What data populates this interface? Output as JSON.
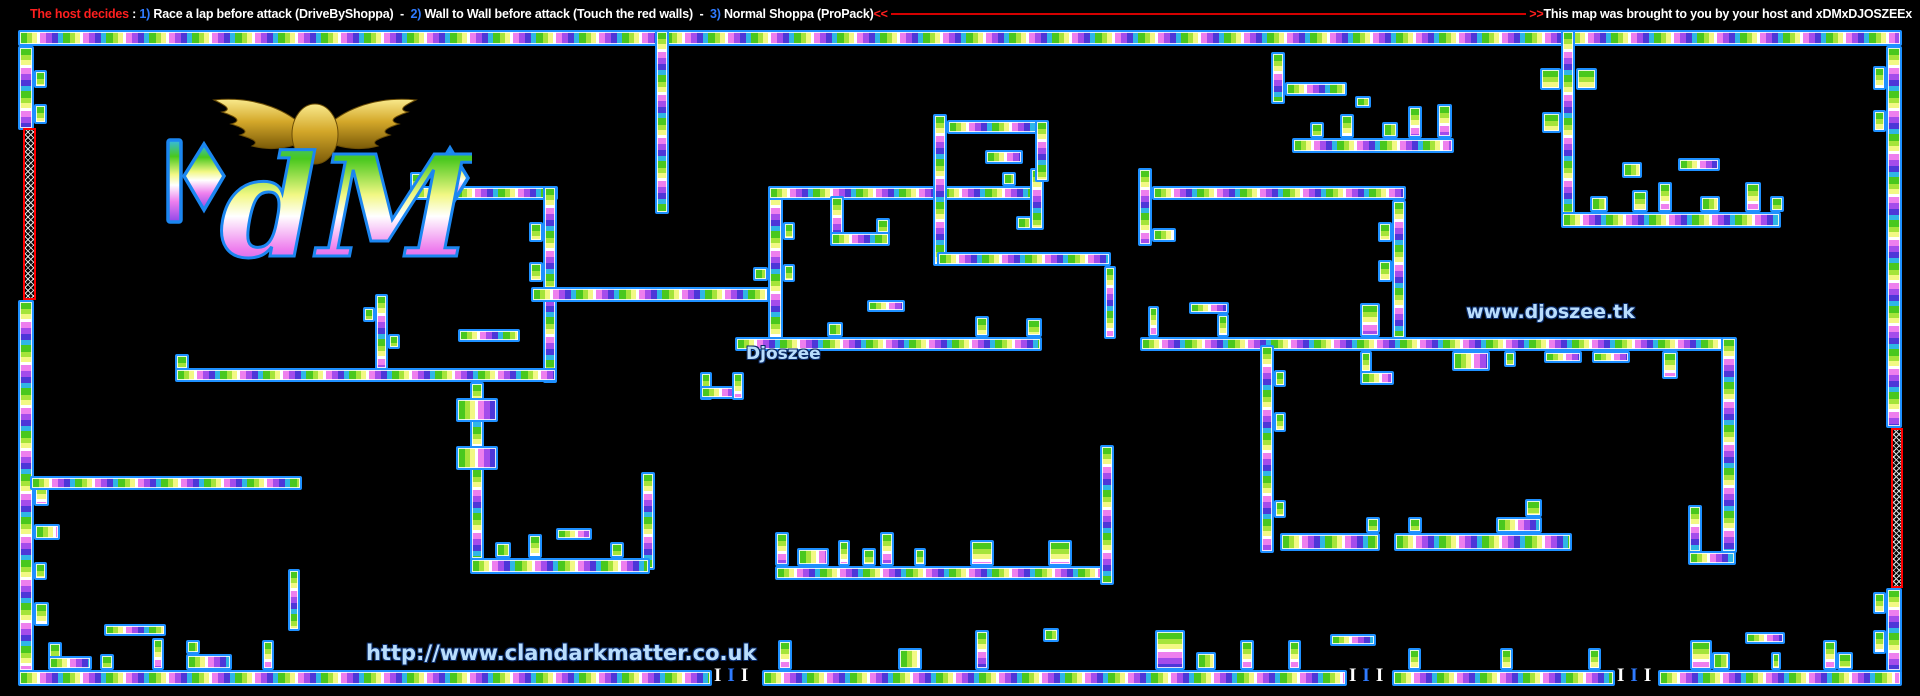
{
  "header": {
    "left_segments": [
      {
        "text": "The host decides",
        "color": "#ff1f1f"
      },
      {
        "text": " : ",
        "color": "#ffffff"
      },
      {
        "text": "1)",
        "color": "#2f7bff"
      },
      {
        "text": " Race a lap before attack (DriveByShoppa)  -  ",
        "color": "#ffffff"
      },
      {
        "text": "2)",
        "color": "#2f7bff"
      },
      {
        "text": " Wall to Wall before attack (Touch the red walls)  -  ",
        "color": "#ffffff"
      },
      {
        "text": "3)",
        "color": "#2f7bff"
      },
      {
        "text": " Normal Shoppa (ProPack)",
        "color": "#ffffff"
      },
      {
        "text": "<<",
        "color": "#ff1f1f"
      }
    ],
    "right_segments": [
      {
        "text": ">>",
        "color": "#ff1f1f"
      },
      {
        "text": "This map was brought to you by your host and xDMxDJOSZEEx",
        "color": "#ffffff"
      }
    ],
    "divider_line_color": "#d40000"
  },
  "logo": {
    "letters": "dM",
    "clan_name": "Dark Matter",
    "wing_color": "#d4a82a",
    "outline_color": "#1b86f0"
  },
  "map": {
    "background": "#000000",
    "wall_border_color": "#1e90ff",
    "wall_gradient_colors": [
      "#49c81e",
      "#a5e43a",
      "#f2f884",
      "#ffffff",
      "#ee7fee",
      "#a44ceb",
      "#4d37d8",
      "#2fb6e6"
    ],
    "red_wall_border_color": "#ff0000",
    "labels": [
      {
        "name": "player-label",
        "text": "Djoszee",
        "x": 746,
        "y": 344,
        "size": 17
      },
      {
        "name": "website-label",
        "text": "www.djoszee.tk",
        "x": 1466,
        "y": 301,
        "size": 19
      },
      {
        "name": "clan-website-label",
        "text": "http://www.clandarkmatter.co.uk",
        "x": 366,
        "y": 641,
        "size": 21
      }
    ],
    "spawn_marker_groups": [
      {
        "x": 714,
        "y": 668
      },
      {
        "x": 1349,
        "y": 668
      },
      {
        "x": 1617,
        "y": 668
      }
    ],
    "spawn_marker_chars": [
      "I",
      "I",
      "I"
    ],
    "spawn_marker_colors": [
      "#ffffff",
      "#2f7bff",
      "#ffffff"
    ],
    "walls": [
      [
        18,
        30,
        1884,
        16
      ],
      [
        18,
        46,
        16,
        84
      ],
      [
        18,
        300,
        16,
        372
      ],
      [
        34,
        70,
        13,
        18
      ],
      [
        34,
        104,
        13,
        20
      ],
      [
        34,
        480,
        15,
        26
      ],
      [
        34,
        524,
        26,
        16
      ],
      [
        34,
        562,
        13,
        18
      ],
      [
        34,
        602,
        15,
        24
      ],
      [
        1886,
        46,
        16,
        382
      ],
      [
        1886,
        588,
        16,
        84
      ],
      [
        1873,
        66,
        13,
        24
      ],
      [
        1873,
        110,
        13,
        22
      ],
      [
        1873,
        592,
        13,
        22
      ],
      [
        1873,
        630,
        13,
        24
      ],
      [
        410,
        172,
        14,
        16
      ],
      [
        410,
        186,
        148,
        14
      ],
      [
        543,
        186,
        14,
        197
      ],
      [
        529,
        222,
        14,
        20
      ],
      [
        529,
        262,
        14,
        20
      ],
      [
        175,
        354,
        14,
        16
      ],
      [
        175,
        368,
        382,
        14
      ],
      [
        470,
        382,
        14,
        178
      ],
      [
        456,
        398,
        42,
        24
      ],
      [
        456,
        446,
        42,
        24
      ],
      [
        458,
        329,
        62,
        13
      ],
      [
        375,
        294,
        13,
        76
      ],
      [
        363,
        307,
        12,
        15
      ],
      [
        388,
        334,
        12,
        15
      ],
      [
        655,
        30,
        14,
        184
      ],
      [
        531,
        287,
        238,
        15
      ],
      [
        768,
        186,
        15,
        166
      ],
      [
        753,
        267,
        15,
        14
      ],
      [
        783,
        222,
        12,
        18
      ],
      [
        783,
        264,
        12,
        18
      ],
      [
        768,
        186,
        271,
        14
      ],
      [
        1030,
        168,
        14,
        62
      ],
      [
        1016,
        216,
        16,
        14
      ],
      [
        830,
        196,
        14,
        50
      ],
      [
        830,
        232,
        60,
        14
      ],
      [
        876,
        218,
        14,
        16
      ],
      [
        735,
        337,
        307,
        14
      ],
      [
        827,
        322,
        16,
        15
      ],
      [
        975,
        316,
        14,
        21
      ],
      [
        1026,
        318,
        16,
        19
      ],
      [
        867,
        300,
        38,
        12
      ],
      [
        700,
        372,
        12,
        28
      ],
      [
        700,
        386,
        44,
        13
      ],
      [
        732,
        372,
        12,
        28
      ],
      [
        641,
        472,
        14,
        98
      ],
      [
        30,
        476,
        272,
        14
      ],
      [
        104,
        624,
        62,
        12
      ],
      [
        288,
        569,
        12,
        62
      ],
      [
        48,
        642,
        14,
        28
      ],
      [
        48,
        656,
        44,
        14
      ],
      [
        100,
        654,
        14,
        16
      ],
      [
        152,
        638,
        12,
        32
      ],
      [
        186,
        640,
        14,
        14
      ],
      [
        186,
        654,
        46,
        16
      ],
      [
        262,
        640,
        12,
        30
      ],
      [
        470,
        558,
        180,
        16
      ],
      [
        495,
        542,
        16,
        16
      ],
      [
        528,
        534,
        14,
        24
      ],
      [
        610,
        542,
        14,
        16
      ],
      [
        556,
        528,
        36,
        12
      ],
      [
        775,
        566,
        333,
        14
      ],
      [
        775,
        532,
        14,
        34
      ],
      [
        797,
        548,
        32,
        18
      ],
      [
        838,
        540,
        12,
        26
      ],
      [
        862,
        548,
        14,
        18
      ],
      [
        880,
        532,
        14,
        34
      ],
      [
        914,
        548,
        12,
        18
      ],
      [
        970,
        540,
        24,
        26
      ],
      [
        1048,
        540,
        24,
        26
      ],
      [
        1100,
        445,
        14,
        140
      ],
      [
        933,
        114,
        14,
        152
      ],
      [
        947,
        120,
        100,
        14
      ],
      [
        1035,
        120,
        14,
        62
      ],
      [
        985,
        150,
        38,
        14
      ],
      [
        1002,
        172,
        14,
        14
      ],
      [
        937,
        252,
        174,
        14
      ],
      [
        1104,
        266,
        12,
        73
      ],
      [
        1138,
        168,
        14,
        78
      ],
      [
        1152,
        228,
        24,
        14
      ],
      [
        1152,
        186,
        254,
        14
      ],
      [
        1392,
        200,
        14,
        139
      ],
      [
        1378,
        222,
        14,
        20
      ],
      [
        1378,
        260,
        14,
        22
      ],
      [
        1140,
        337,
        583,
        14
      ],
      [
        1148,
        306,
        11,
        31
      ],
      [
        1189,
        302,
        40,
        12
      ],
      [
        1217,
        314,
        12,
        23
      ],
      [
        1360,
        303,
        20,
        34
      ],
      [
        1452,
        351,
        38,
        20
      ],
      [
        1504,
        351,
        12,
        16
      ],
      [
        1544,
        351,
        38,
        12
      ],
      [
        1592,
        351,
        38,
        12
      ],
      [
        1662,
        351,
        16,
        28
      ],
      [
        1360,
        351,
        12,
        34
      ],
      [
        1360,
        371,
        34,
        14
      ],
      [
        1721,
        337,
        16,
        216
      ],
      [
        1688,
        505,
        14,
        48
      ],
      [
        1688,
        551,
        48,
        14
      ],
      [
        1260,
        345,
        14,
        208
      ],
      [
        1274,
        370,
        12,
        17
      ],
      [
        1274,
        412,
        12,
        20
      ],
      [
        1274,
        500,
        12,
        18
      ],
      [
        1280,
        533,
        100,
        18
      ],
      [
        1366,
        517,
        14,
        16
      ],
      [
        1394,
        533,
        178,
        18
      ],
      [
        1408,
        517,
        14,
        16
      ],
      [
        1496,
        517,
        46,
        16
      ],
      [
        1525,
        499,
        17,
        18
      ],
      [
        1561,
        30,
        14,
        190
      ],
      [
        1540,
        68,
        21,
        22
      ],
      [
        1576,
        68,
        21,
        22
      ],
      [
        1542,
        112,
        19,
        21
      ],
      [
        1561,
        212,
        220,
        16
      ],
      [
        1590,
        196,
        18,
        16
      ],
      [
        1632,
        190,
        16,
        22
      ],
      [
        1658,
        182,
        14,
        30
      ],
      [
        1700,
        196,
        20,
        16
      ],
      [
        1745,
        182,
        16,
        30
      ],
      [
        1770,
        196,
        14,
        16
      ],
      [
        1622,
        162,
        20,
        16
      ],
      [
        1678,
        158,
        42,
        13
      ],
      [
        1271,
        52,
        14,
        52
      ],
      [
        1285,
        82,
        62,
        14
      ],
      [
        1292,
        138,
        162,
        15
      ],
      [
        1310,
        122,
        14,
        16
      ],
      [
        1340,
        114,
        14,
        24
      ],
      [
        1382,
        122,
        16,
        16
      ],
      [
        1408,
        106,
        14,
        32
      ],
      [
        1437,
        104,
        15,
        34
      ],
      [
        1355,
        96,
        16,
        12
      ],
      [
        18,
        670,
        694,
        16
      ],
      [
        762,
        670,
        585,
        16
      ],
      [
        1392,
        670,
        223,
        16
      ],
      [
        1658,
        670,
        244,
        16
      ],
      [
        778,
        640,
        14,
        30
      ],
      [
        898,
        648,
        24,
        22
      ],
      [
        975,
        630,
        14,
        40
      ],
      [
        1043,
        628,
        16,
        14
      ],
      [
        1155,
        630,
        30,
        40
      ],
      [
        1196,
        652,
        20,
        18
      ],
      [
        1240,
        640,
        14,
        30
      ],
      [
        1330,
        634,
        46,
        12
      ],
      [
        1288,
        640,
        13,
        30
      ],
      [
        1408,
        648,
        13,
        22
      ],
      [
        1500,
        648,
        13,
        22
      ],
      [
        1588,
        648,
        13,
        22
      ],
      [
        1690,
        640,
        22,
        30
      ],
      [
        1712,
        652,
        18,
        18
      ],
      [
        1745,
        632,
        40,
        12
      ],
      [
        1771,
        652,
        10,
        18
      ],
      [
        1823,
        640,
        14,
        30
      ],
      [
        1837,
        652,
        16,
        18
      ]
    ],
    "red_walls": [
      [
        23,
        128,
        13,
        172
      ],
      [
        1891,
        428,
        12,
        160
      ]
    ]
  }
}
